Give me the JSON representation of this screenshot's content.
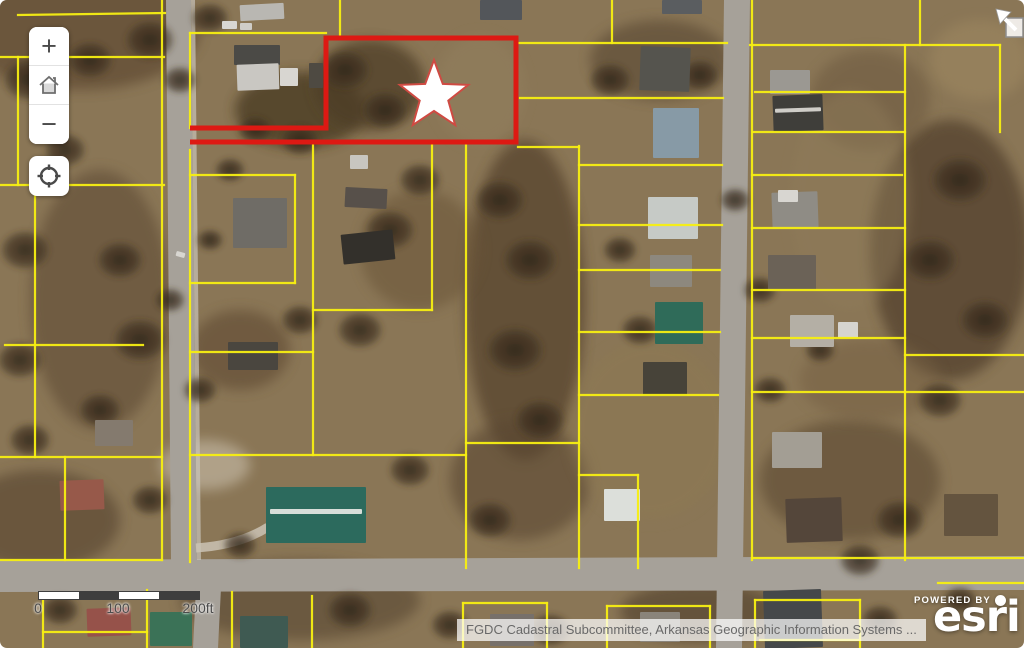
{
  "map": {
    "colors": {
      "ground": "#8a7656",
      "parcel_line": "#f7ef12",
      "highlight": "#dd1913",
      "road": "#a6a199",
      "road_curb": "#c9c4ba",
      "star_fill": "#ffffff",
      "star_stroke": "#cf4a42",
      "scale_dark": "#3e3e3e",
      "scale_light": "#ffffff"
    },
    "controls": {
      "zoom_in_label": "+",
      "zoom_out_label": "−",
      "home_icon": "home",
      "locate_icon": "locate-crosshair"
    },
    "scale_bar": {
      "labels": [
        "0",
        "100",
        "200ft"
      ],
      "label_x": [
        0,
        80,
        160
      ],
      "segment_colors": [
        "#ffffff",
        "#3e3e3e",
        "#ffffff",
        "#3e3e3e"
      ]
    },
    "attribution_text": "FGDC Cadastral Subcommittee, Arkansas Geographic Information Systems ...",
    "esri": {
      "powered_by": "POWERED BY",
      "brand": "esri"
    },
    "highlight_parcel": {
      "points": "190,128 326,128 326,38 516,38 516,142 190,142"
    },
    "star": {
      "points": "434,60 442.8,83.9 468.2,84.9 448.3,100.6 455.2,125.1 434,111 412.8,125.1 419.7,100.6 399.8,84.9 425.2,83.9"
    },
    "roads": [
      "166,0 191,0 197,562 171,562",
      "724,0 750,0 742,648 716,648",
      "0,560 1024,556 1024,590 0,592",
      "196,588 221,588 218,648 193,648"
    ],
    "curbs": [
      "191,0 195,0 201,560 197,560"
    ],
    "parcel_segments": [
      [
        18,
        15,
        165,
        13
      ],
      [
        0,
        57,
        164,
        57
      ],
      [
        18,
        57,
        18,
        185
      ],
      [
        0,
        185,
        164,
        185
      ],
      [
        35,
        185,
        35,
        457
      ],
      [
        5,
        345,
        143,
        345
      ],
      [
        0,
        457,
        162,
        457
      ],
      [
        65,
        457,
        65,
        560
      ],
      [
        0,
        560,
        162,
        560
      ],
      [
        162,
        0,
        162,
        560
      ],
      [
        43,
        594,
        43,
        648
      ],
      [
        147,
        590,
        147,
        648
      ],
      [
        43,
        632,
        147,
        632
      ],
      [
        232,
        592,
        232,
        648
      ],
      [
        312,
        596,
        312,
        648
      ],
      [
        340,
        0,
        340,
        35
      ],
      [
        190,
        33,
        326,
        33
      ],
      [
        190,
        33,
        190,
        128
      ],
      [
        190,
        150,
        190,
        562
      ],
      [
        190,
        175,
        295,
        175
      ],
      [
        295,
        175,
        295,
        283
      ],
      [
        190,
        283,
        295,
        283
      ],
      [
        313,
        143,
        313,
        455
      ],
      [
        313,
        310,
        432,
        310
      ],
      [
        432,
        143,
        432,
        310
      ],
      [
        466,
        143,
        466,
        568
      ],
      [
        190,
        352,
        313,
        352
      ],
      [
        190,
        455,
        466,
        455
      ],
      [
        466,
        443,
        579,
        443
      ],
      [
        579,
        146,
        579,
        568
      ],
      [
        579,
        475,
        638,
        475
      ],
      [
        638,
        475,
        638,
        568
      ],
      [
        518,
        147,
        579,
        147
      ],
      [
        519,
        43,
        727,
        43
      ],
      [
        612,
        0,
        612,
        43
      ],
      [
        520,
        98,
        723,
        98
      ],
      [
        579,
        165,
        722,
        165
      ],
      [
        579,
        225,
        722,
        225
      ],
      [
        579,
        270,
        720,
        270
      ],
      [
        579,
        332,
        720,
        332
      ],
      [
        579,
        395,
        718,
        395
      ],
      [
        463,
        603,
        547,
        603
      ],
      [
        463,
        603,
        463,
        648
      ],
      [
        547,
        603,
        547,
        648
      ],
      [
        607,
        606,
        710,
        606
      ],
      [
        607,
        606,
        607,
        648
      ],
      [
        710,
        606,
        710,
        648
      ],
      [
        750,
        45,
        1000,
        45
      ],
      [
        920,
        0,
        920,
        45
      ],
      [
        1000,
        45,
        1000,
        132
      ],
      [
        752,
        0,
        752,
        560
      ],
      [
        755,
        92,
        905,
        92
      ],
      [
        753,
        132,
        905,
        132
      ],
      [
        752,
        175,
        902,
        175
      ],
      [
        905,
        45,
        905,
        560
      ],
      [
        752,
        228,
        905,
        228
      ],
      [
        752,
        290,
        905,
        290
      ],
      [
        752,
        338,
        905,
        338
      ],
      [
        752,
        392,
        1024,
        392
      ],
      [
        905,
        355,
        1024,
        355
      ],
      [
        752,
        558,
        1024,
        558
      ],
      [
        938,
        583,
        1024,
        583
      ],
      [
        755,
        600,
        755,
        648
      ],
      [
        755,
        600,
        860,
        600
      ],
      [
        860,
        600,
        860,
        648
      ],
      [
        760,
        640,
        860,
        640
      ]
    ],
    "patches": [
      [
        80,
        30,
        120,
        60,
        "#5e4a33",
        0.7
      ],
      [
        300,
        110,
        65,
        38,
        "#43341f",
        0.7
      ],
      [
        370,
        85,
        55,
        45,
        "#4e3d27",
        0.75
      ],
      [
        480,
        90,
        45,
        55,
        "#93805e",
        0.5
      ],
      [
        525,
        300,
        60,
        160,
        "#52412c",
        0.7
      ],
      [
        520,
        480,
        70,
        60,
        "#5a4630",
        0.6
      ],
      [
        100,
        300,
        70,
        130,
        "#5f4c35",
        0.6
      ],
      [
        40,
        520,
        80,
        50,
        "#55432e",
        0.6
      ],
      [
        660,
        60,
        70,
        40,
        "#584631",
        0.6
      ],
      [
        950,
        250,
        80,
        130,
        "#4f3e2a",
        0.7
      ],
      [
        870,
        100,
        60,
        50,
        "#6a563c",
        0.5
      ],
      [
        980,
        60,
        50,
        40,
        "#a08a62",
        0.5
      ],
      [
        650,
        430,
        80,
        90,
        "#8d7952",
        0.5
      ],
      [
        850,
        480,
        90,
        60,
        "#5c4930",
        0.6
      ],
      [
        300,
        600,
        120,
        40,
        "#584733",
        0.6
      ],
      [
        700,
        612,
        80,
        30,
        "#4e3d2a",
        0.6
      ],
      [
        205,
        465,
        45,
        25,
        "#cfc5b2",
        0.55
      ],
      [
        870,
        380,
        70,
        40,
        "#745f42",
        0.5
      ],
      [
        420,
        250,
        60,
        60,
        "#6a5539",
        0.55
      ],
      [
        240,
        350,
        50,
        40,
        "#5e4a33",
        0.6
      ],
      [
        850,
        200,
        60,
        110,
        "#8f7c5a",
        0.45
      ]
    ],
    "trees": [
      [
        30,
        80,
        28
      ],
      [
        90,
        60,
        24
      ],
      [
        150,
        40,
        26
      ],
      [
        210,
        18,
        20
      ],
      [
        65,
        150,
        22
      ],
      [
        25,
        250,
        26
      ],
      [
        20,
        360,
        24
      ],
      [
        30,
        440,
        22
      ],
      [
        120,
        260,
        24
      ],
      [
        140,
        340,
        28
      ],
      [
        100,
        410,
        22
      ],
      [
        345,
        70,
        26
      ],
      [
        385,
        110,
        24
      ],
      [
        300,
        140,
        20
      ],
      [
        255,
        130,
        18
      ],
      [
        420,
        180,
        22
      ],
      [
        390,
        230,
        26
      ],
      [
        360,
        330,
        24
      ],
      [
        300,
        320,
        20
      ],
      [
        500,
        200,
        26
      ],
      [
        530,
        260,
        28
      ],
      [
        515,
        350,
        30
      ],
      [
        540,
        420,
        26
      ],
      [
        490,
        520,
        24
      ],
      [
        610,
        80,
        22
      ],
      [
        700,
        75,
        20
      ],
      [
        620,
        250,
        18
      ],
      [
        640,
        330,
        20
      ],
      [
        960,
        180,
        30
      ],
      [
        930,
        260,
        28
      ],
      [
        985,
        320,
        26
      ],
      [
        940,
        400,
        24
      ],
      [
        900,
        520,
        26
      ],
      [
        860,
        560,
        22
      ],
      [
        760,
        290,
        18
      ],
      [
        735,
        200,
        16
      ],
      [
        770,
        390,
        18
      ],
      [
        820,
        350,
        16
      ],
      [
        350,
        610,
        24
      ],
      [
        450,
        625,
        20
      ],
      [
        550,
        630,
        22
      ],
      [
        880,
        620,
        20
      ],
      [
        960,
        600,
        18
      ],
      [
        60,
        610,
        20
      ],
      [
        240,
        545,
        18
      ],
      [
        410,
        470,
        22
      ],
      [
        180,
        80,
        18
      ],
      [
        230,
        170,
        16
      ],
      [
        210,
        240,
        14
      ],
      [
        170,
        300,
        16
      ],
      [
        200,
        390,
        18
      ],
      [
        150,
        500,
        20
      ]
    ],
    "buildings": [
      [
        234,
        45,
        46,
        20,
        "#4b4a46",
        0
      ],
      [
        237,
        64,
        42,
        26,
        "#c9c7c2",
        -2
      ],
      [
        280,
        68,
        18,
        18,
        "#d8d6d1",
        0
      ],
      [
        309,
        63,
        14,
        25,
        "#4e4a42",
        0
      ],
      [
        240,
        4,
        44,
        16,
        "#b9b7b2",
        -3
      ],
      [
        345,
        188,
        42,
        20,
        "#57504a",
        3
      ],
      [
        342,
        232,
        52,
        30,
        "#33302b",
        -6
      ],
      [
        233,
        198,
        54,
        50,
        "#6f6c66",
        0
      ],
      [
        350,
        155,
        18,
        14,
        "#c8c6c0",
        0
      ],
      [
        228,
        342,
        50,
        28,
        "#4a463f",
        0
      ],
      [
        266,
        487,
        100,
        56,
        "#2c6a5d",
        0
      ],
      [
        270,
        509,
        92,
        5,
        "#d7ded9",
        0
      ],
      [
        604,
        489,
        36,
        32,
        "#dcdfda",
        0
      ],
      [
        640,
        47,
        50,
        44,
        "#55544e",
        2
      ],
      [
        653,
        108,
        46,
        50,
        "#879aa6",
        0
      ],
      [
        648,
        197,
        50,
        42,
        "#c6cac6",
        0
      ],
      [
        650,
        255,
        42,
        32,
        "#8d887e",
        0
      ],
      [
        655,
        302,
        48,
        42,
        "#2f6b59",
        0
      ],
      [
        643,
        362,
        44,
        34,
        "#474339",
        0
      ],
      [
        770,
        70,
        40,
        24,
        "#9b9892",
        0
      ],
      [
        773,
        95,
        50,
        36,
        "#3f3e3a",
        -2
      ],
      [
        775,
        108,
        46,
        4,
        "#cfcdc8",
        -2
      ],
      [
        772,
        192,
        46,
        36,
        "#8f8c85",
        -2
      ],
      [
        778,
        190,
        20,
        12,
        "#d8d6d1",
        0
      ],
      [
        768,
        255,
        48,
        36,
        "#6b6257",
        0
      ],
      [
        790,
        315,
        44,
        32,
        "#b4afa5",
        0
      ],
      [
        838,
        322,
        20,
        16,
        "#d6d4cf",
        0
      ],
      [
        772,
        432,
        50,
        36,
        "#a39e94",
        0
      ],
      [
        786,
        498,
        56,
        44,
        "#54463a",
        -2
      ],
      [
        944,
        494,
        54,
        42,
        "#64543f",
        0
      ],
      [
        764,
        590,
        58,
        58,
        "#45484a",
        -2
      ],
      [
        150,
        612,
        42,
        34,
        "#3b7257",
        0
      ],
      [
        87,
        608,
        44,
        28,
        "#96524a",
        -2
      ],
      [
        240,
        616,
        48,
        32,
        "#3f5a52",
        0
      ],
      [
        480,
        0,
        42,
        20,
        "#53565a",
        0
      ],
      [
        662,
        0,
        40,
        14,
        "#5a5d60",
        0
      ],
      [
        60,
        480,
        44,
        30,
        "#97594a",
        -2
      ],
      [
        95,
        420,
        38,
        26,
        "#847a6e",
        0
      ],
      [
        490,
        614,
        44,
        32,
        "#77706a",
        0
      ],
      [
        640,
        612,
        40,
        30,
        "#8a847a",
        0
      ],
      [
        222,
        21,
        15,
        8,
        "#d9d7d2",
        0
      ],
      [
        240,
        23,
        12,
        7,
        "#cfcdc8",
        0
      ],
      [
        176,
        252,
        9,
        5,
        "#d8d6d1",
        15
      ]
    ],
    "driveways": [
      "M 196 548 Q 240 545 268 527"
    ]
  }
}
